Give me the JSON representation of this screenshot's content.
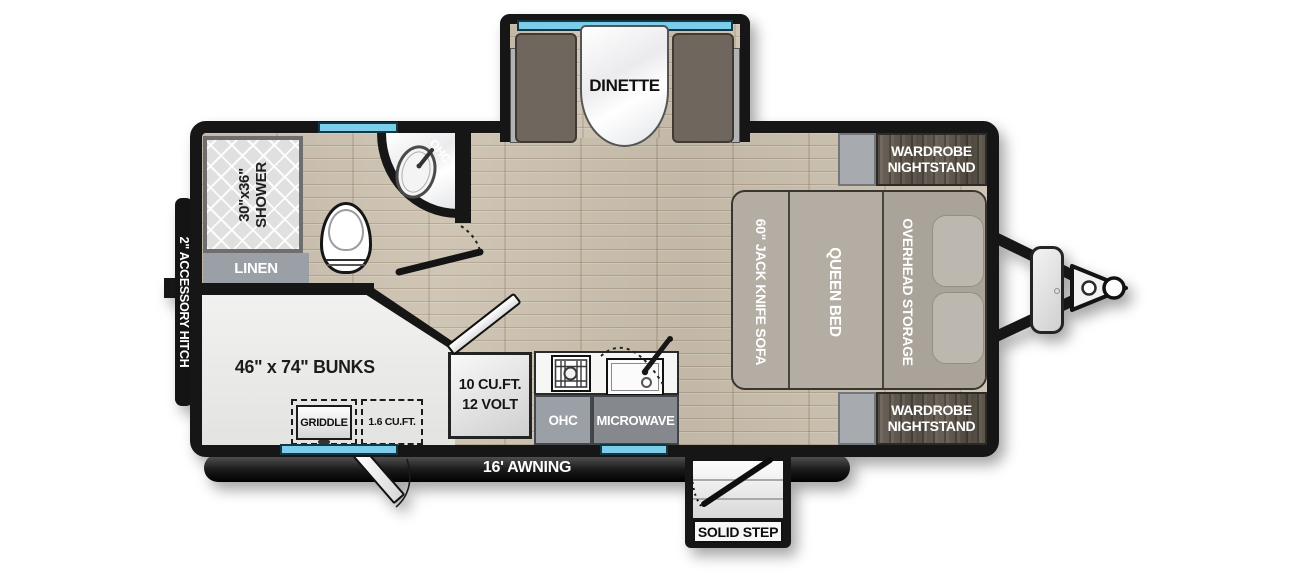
{
  "plan": {
    "exterior": {
      "accessory_hitch_label": "2\" ACCESSORY HITCH",
      "awning_label": "16' AWNING",
      "solid_step_label": "SOLID STEP"
    },
    "dinette": {
      "label": "DINETTE"
    },
    "bathroom": {
      "shower": {
        "line1": "30\"x36\"",
        "line2": "SHOWER"
      },
      "linen_label": "LINEN",
      "ohc_label": "OHC"
    },
    "bunk_room": {
      "bunks_label": "46\" x 74\" BUNKS",
      "griddle_label": "GRIDDLE",
      "mini_fridge_label": "1.6 CU.FT."
    },
    "kitchen": {
      "fridge": {
        "line1": "10 CU.FT.",
        "line2": "12 VOLT"
      },
      "ohc_label": "OHC",
      "microwave_label": "MICROWAVE"
    },
    "bedroom": {
      "sofa_label": "60\" JACK KNIFE SOFA",
      "queen_bed_label": "QUEEN BED",
      "overhead_storage_label": "OVERHEAD STORAGE",
      "wardrobe": {
        "line1": "WARDROBE",
        "line2": "NIGHTSTAND"
      }
    },
    "colors": {
      "wall": "#161616",
      "floor_wood": "#cdc2b0",
      "window_blue": "#7ccdea",
      "bench_brown": "#6f675d",
      "bed_taupe": "#b4ada3",
      "wardrobe_wood": "#5d564c",
      "cabinet_gray": "#9aa0a5",
      "bunk_light": "#ececec"
    }
  }
}
